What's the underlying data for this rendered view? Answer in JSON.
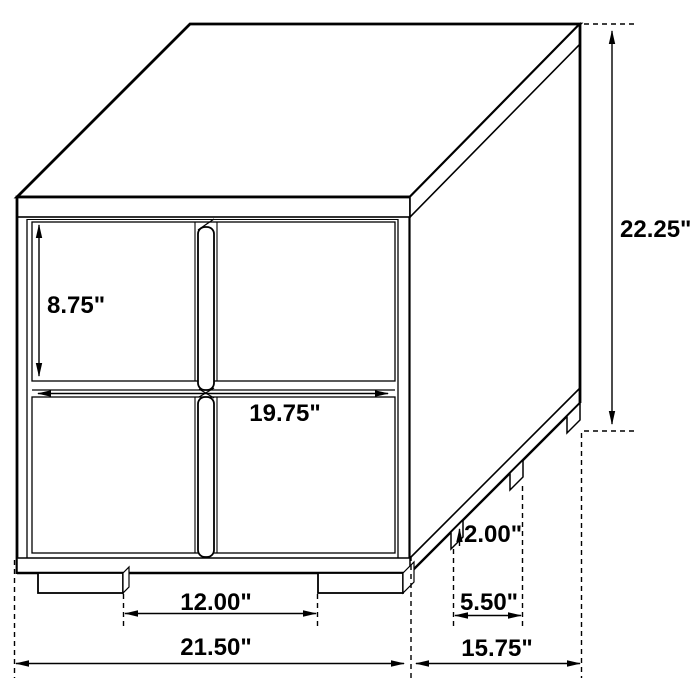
{
  "canvas": {
    "background_color": "#ffffff",
    "line_color": "#000000",
    "text_color": "#000000"
  },
  "diagram": {
    "type": "furniture-dimension-line-drawing",
    "subject": "two-drawer nightstand shown in three-quarter perspective with dimension callouts",
    "dimensions": {
      "drawer_height": {
        "label": "8.75\""
      },
      "overall_height": {
        "label": "22.25\""
      },
      "drawer_width": {
        "label": "19.75\""
      },
      "foot_height": {
        "label": "2.00\""
      },
      "front_foot_gap": {
        "label": "12.00\""
      },
      "side_foot_gap": {
        "label": "5.50\""
      },
      "overall_width": {
        "label": "21.50\""
      },
      "overall_depth": {
        "label": "15.75\""
      }
    }
  }
}
